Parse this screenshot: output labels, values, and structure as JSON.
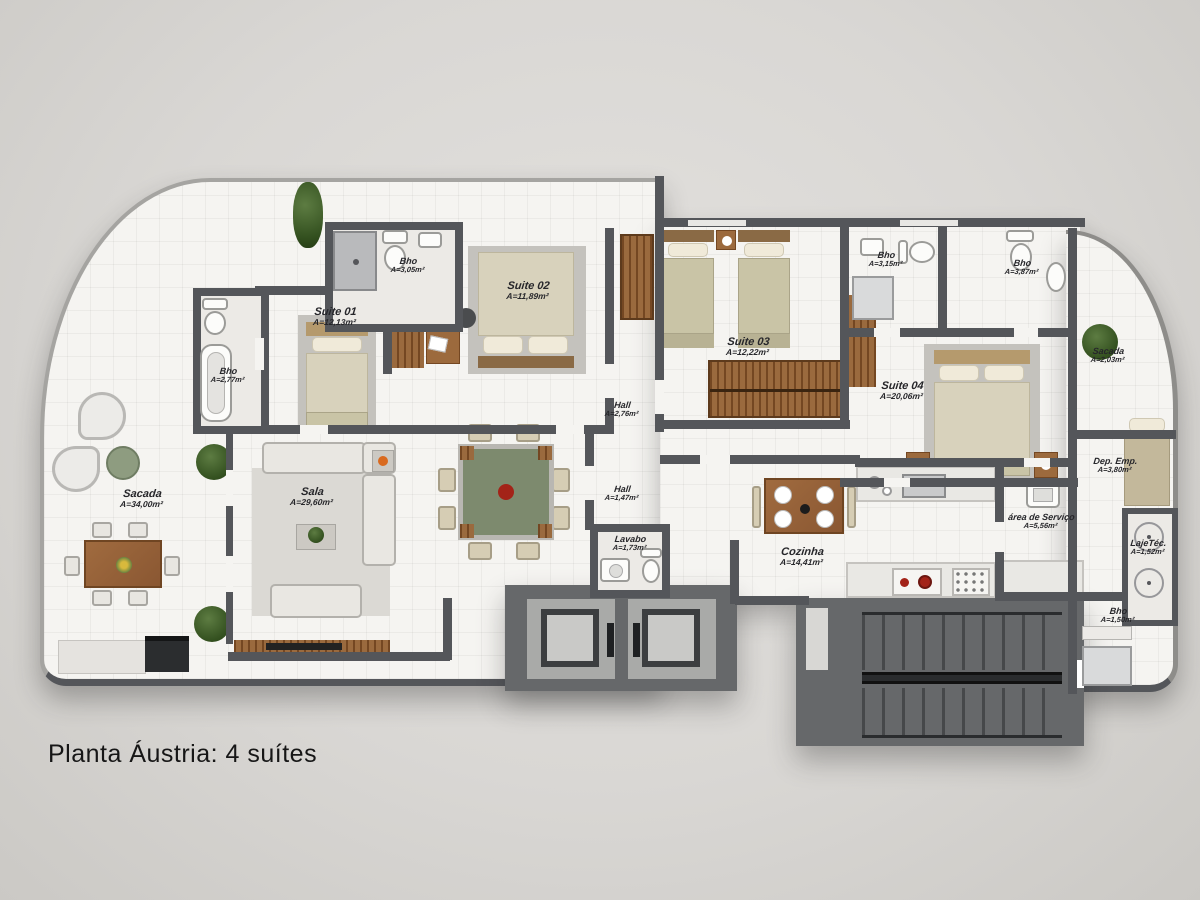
{
  "title": "Planta Áustria: 4 suítes",
  "palette": {
    "background": "#d9d7d4",
    "floor": "#f5f4f1",
    "wall": "#54565a",
    "wood": "#8a5a34",
    "plant_green": "#33501f",
    "table_green": "#7d8a6e",
    "stove_burner_red": "#a32318",
    "label_text": "#26262a"
  },
  "rooms": {
    "sacada_left": {
      "label": "Sacada",
      "area": "A=34,00m²"
    },
    "bho_suite01_left": {
      "label": "Bho",
      "area": "A=2,77m²"
    },
    "suite01": {
      "label": "Suite 01",
      "area": "A=12,13m²"
    },
    "bho_suite01_top": {
      "label": "Bho",
      "area": "A=3,05m²"
    },
    "suite02": {
      "label": "Suite 02",
      "area": "A=11,89m²"
    },
    "suite03": {
      "label": "Suite 03",
      "area": "A=12,22m²"
    },
    "bho_suite03": {
      "label": "Bho",
      "area": "A=3,15m²"
    },
    "bho_suite04": {
      "label": "Bho",
      "area": "A=3,87m²"
    },
    "sacada_right": {
      "label": "Sacada",
      "area": "A=2,03m²"
    },
    "suite04": {
      "label": "Suite 04",
      "area": "A=20,06m²"
    },
    "hall_upper": {
      "label": "Hall",
      "area": "A=2,76m²"
    },
    "hall_lower": {
      "label": "Hall",
      "area": "A=1,47m²"
    },
    "sala": {
      "label": "Sala",
      "area": "A=29,60m²"
    },
    "lavabo": {
      "label": "Lavabo",
      "area": "A=1,73m²"
    },
    "cozinha": {
      "label": "Cozinha",
      "area": "A=14,41m²"
    },
    "area_servico": {
      "label": "área de Serviço",
      "area": "A=5,56m²"
    },
    "dep_emp": {
      "label": "Dep. Emp.",
      "area": "A=3,80m²"
    },
    "laje_tec": {
      "label": "LajeTéc.",
      "area": "A=1,52m²"
    },
    "bho_servico": {
      "label": "Bho",
      "area": "A=1,50m²"
    }
  }
}
